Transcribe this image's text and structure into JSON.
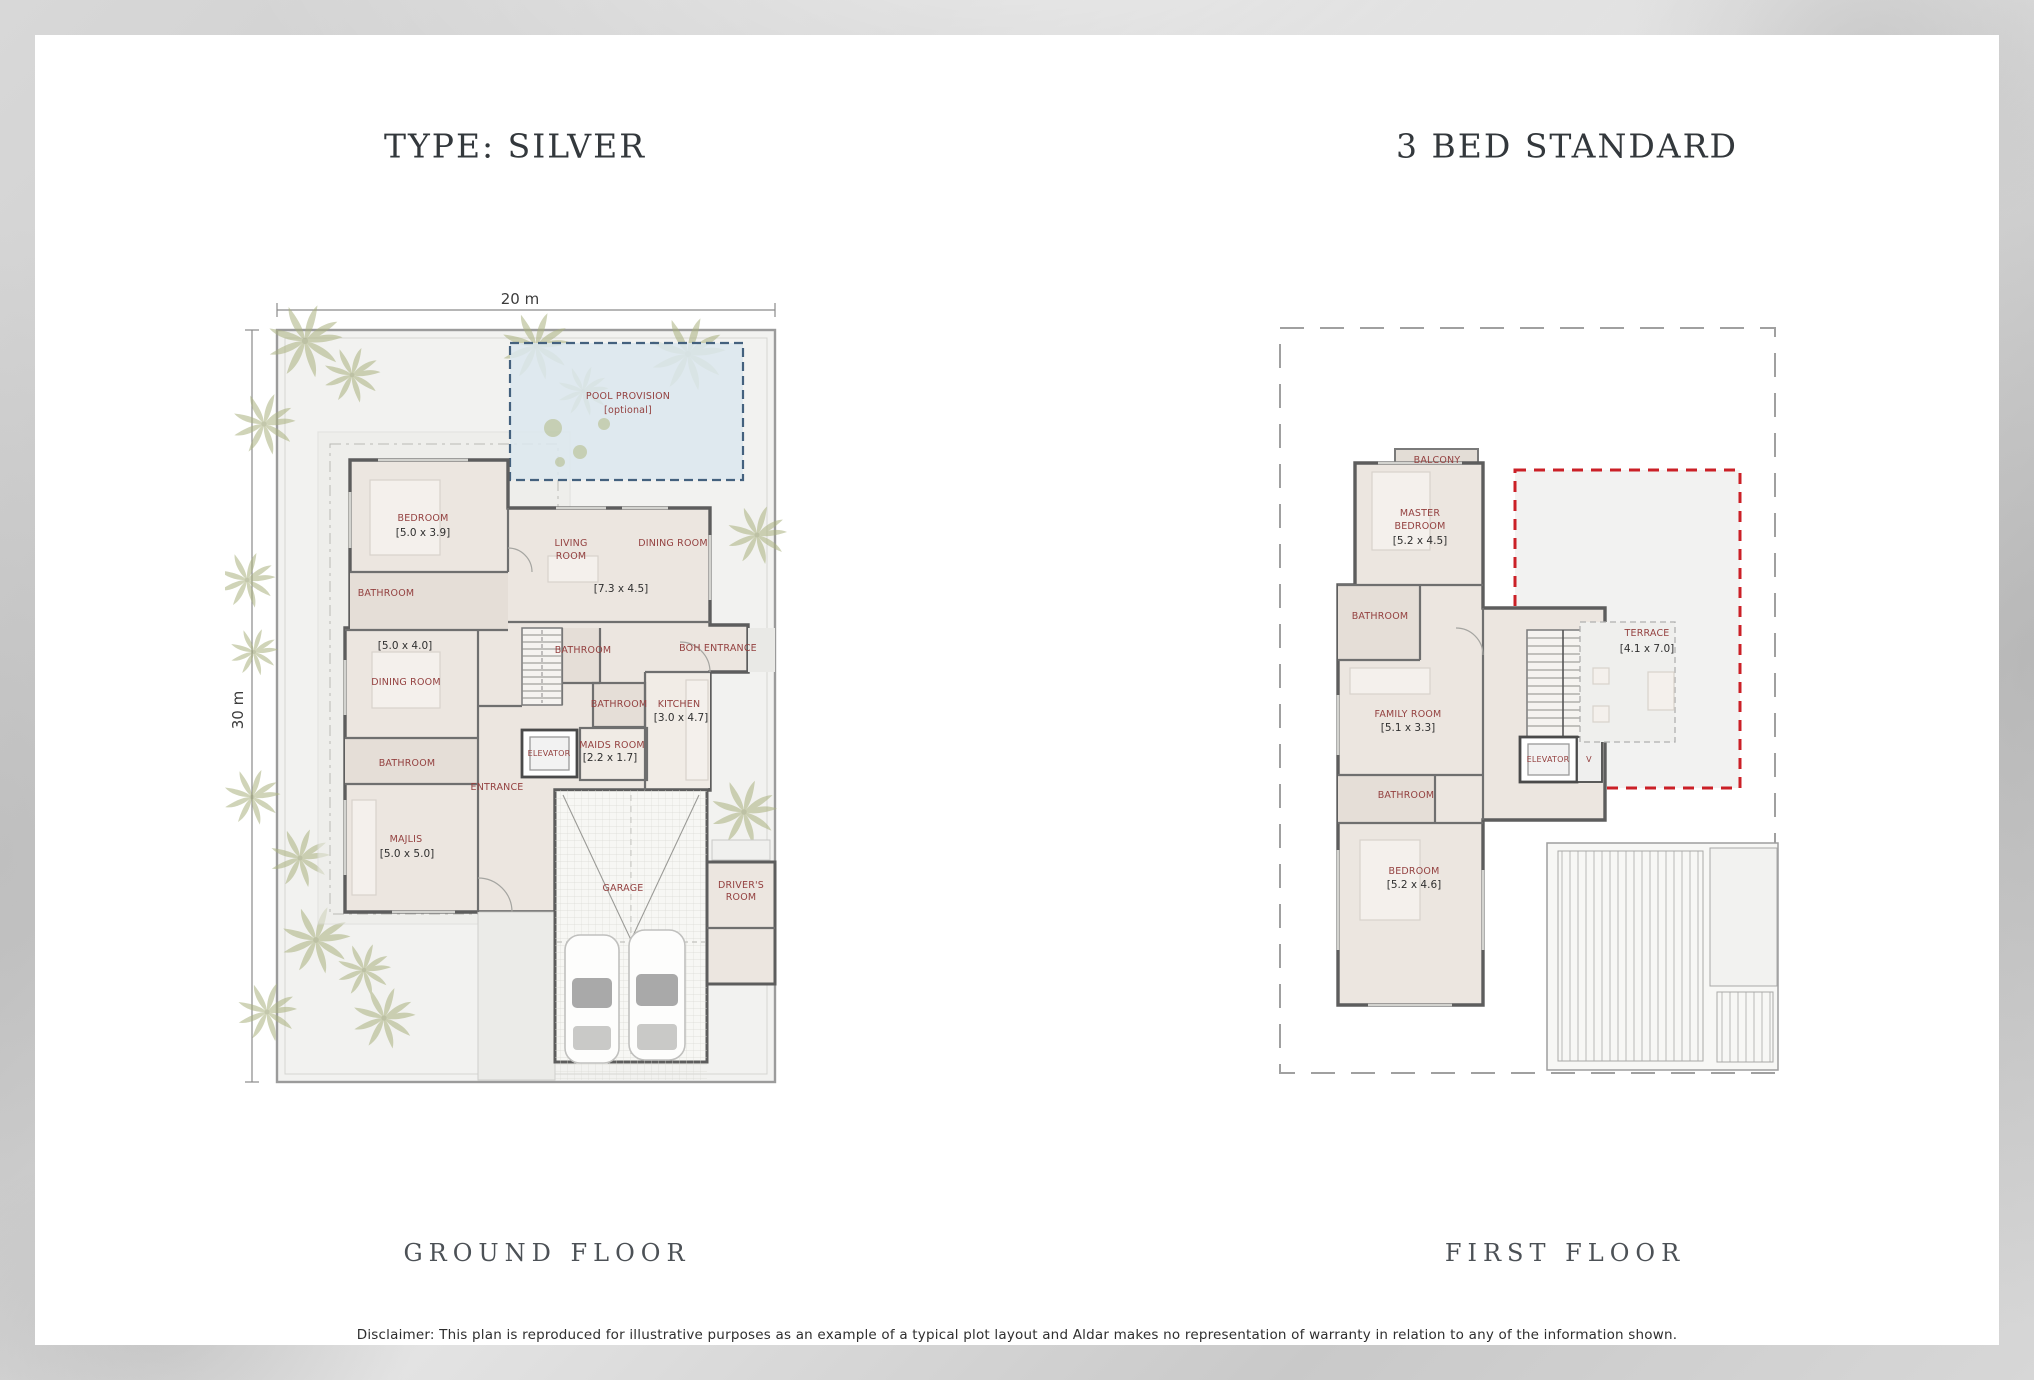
{
  "header": {
    "type_title": "TYPE: SILVER",
    "bed_title": "3 BED STANDARD"
  },
  "ground_floor": {
    "caption": "GROUND FLOOR",
    "dimensions": {
      "width": "20 m",
      "height": "30 m"
    },
    "pool_provision": {
      "title": "POOL PROVISION",
      "subtitle": "[optional]"
    },
    "rooms": {
      "bedroom": "BEDROOM",
      "bedroom_size": "[5.0 x 3.9]",
      "living_line1": "LIVING",
      "living_line2": "ROOM",
      "living_dining_size": "[7.3 x 4.5]",
      "dining_right": "DINING ROOM",
      "bathroom_upper": "BATHROOM",
      "dining_left_size": "[5.0 x 4.0]",
      "dining_left": "DINING ROOM",
      "bathroom_stairs": "BATHROOM",
      "boh_entrance": "BOH ENTRANCE",
      "bathroom_mid": "BATHROOM",
      "kitchen": "KITCHEN",
      "kitchen_size": "[3.0 x 4.7]",
      "maids_room": "MAIDS ROOM",
      "maids_room_size": "[2.2 x 1.7]",
      "elevator": "ELEVATOR",
      "bathroom_lower": "BATHROOM",
      "entrance": "ENTRANCE",
      "majlis": "MAJLIS",
      "majlis_size": "[5.0 x 5.0]",
      "garage": "GARAGE",
      "drivers_room_line1": "DRIVER'S",
      "drivers_room_line2": "ROOM"
    }
  },
  "first_floor": {
    "caption": "FIRST FLOOR",
    "rooms": {
      "balcony": "BALCONY",
      "master_line1": "MASTER",
      "master_line2": "BEDROOM",
      "master_size": "[5.2 x 4.5]",
      "bathroom_upper": "BATHROOM",
      "family_room": "FAMILY ROOM",
      "family_room_size": "[5.1 x 3.3]",
      "elevator": "ELEVATOR",
      "void_shaft": "V",
      "bathroom_mid": "BATHROOM",
      "bedroom": "BEDROOM",
      "bedroom_size": "[5.2 x 4.6]",
      "terrace": "TERRACE",
      "terrace_size": "[4.1 x 7.0]"
    }
  },
  "footer": {
    "disclaimer": "Disclaimer: This plan is reproduced for illustrative purposes as an example of a typical plot layout and Aldar makes no representation of warranty in relation to any of the information shown."
  },
  "colors": {
    "room_label": "#944140",
    "size_label": "#2f2f2f",
    "pool_fill": "#dce8ee",
    "pool_border": "#44617e",
    "terrace_boundary_red": "#cb2027",
    "wall": "#5d5d5d",
    "floor_fill": "#ece6e0",
    "title_text": "#33383c",
    "background_silver": "#d4d4d4"
  }
}
